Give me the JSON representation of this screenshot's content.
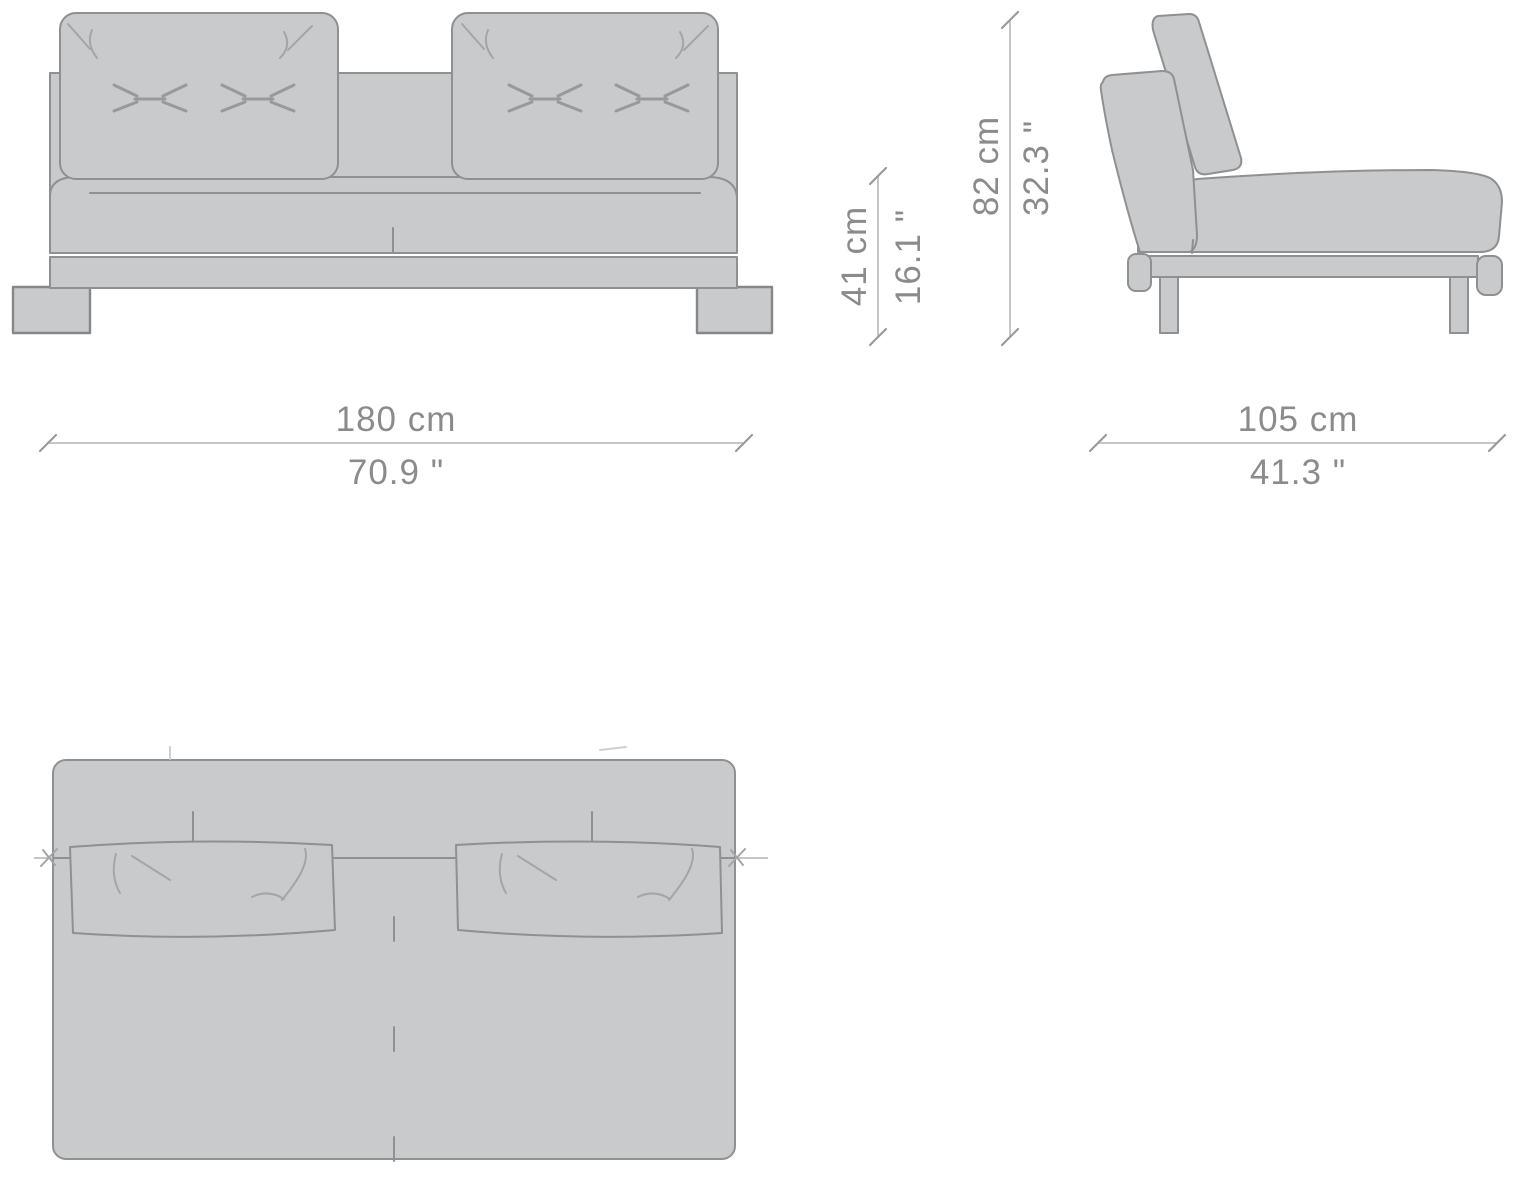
{
  "dimensions": {
    "width": {
      "cm": "180 cm",
      "inch": "70.9 \""
    },
    "depth": {
      "cm": "105 cm",
      "inch": "41.3 \""
    },
    "seat_height": {
      "cm": "41 cm",
      "inch": "16.1 \""
    },
    "overall_height": {
      "cm": "82 cm",
      "inch": "32.3 \""
    }
  },
  "colors": {
    "furniture_fill": "#c9cacb",
    "outline": "#8e9092",
    "dimension_text": "#8b8b8b",
    "dimension_line": "#b3b3b3",
    "background": "#ffffff"
  }
}
